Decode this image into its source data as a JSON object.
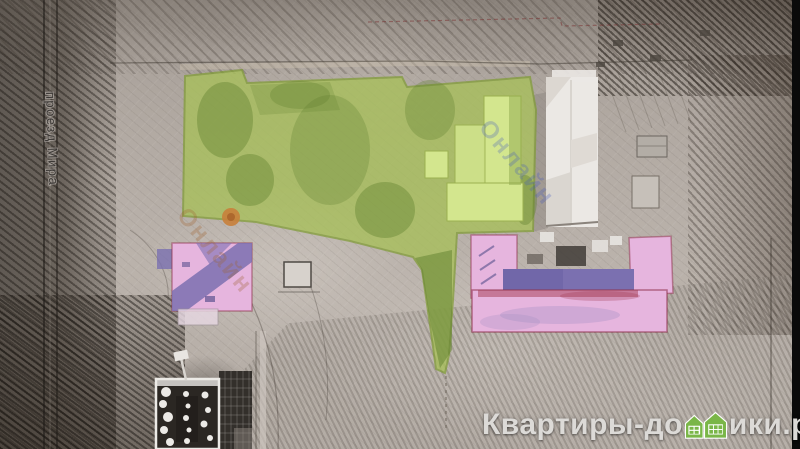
{
  "scene": {
    "street_label": "проезд Мира",
    "diag_watermark_text": "Онлайн",
    "colors": {
      "plot_fill": "#a8c05a",
      "plot_stroke": "#7f9b35",
      "plot_trees": "#5f7f2e",
      "plot_building": "#d3e68e",
      "pink_fill": "#e6b5de",
      "pink_shadow": "#7b70b0",
      "pink_outline": "#8e2f4a",
      "white_building": "#ebe8e4",
      "orange_marker": "#c8803b",
      "edge_bar": "#0a0a0a"
    }
  },
  "watermark": {
    "prefix": "Квартиры-до",
    "suffix": "ики.рф",
    "text_color": "#dcdad7",
    "house_color": "#7ab648"
  }
}
